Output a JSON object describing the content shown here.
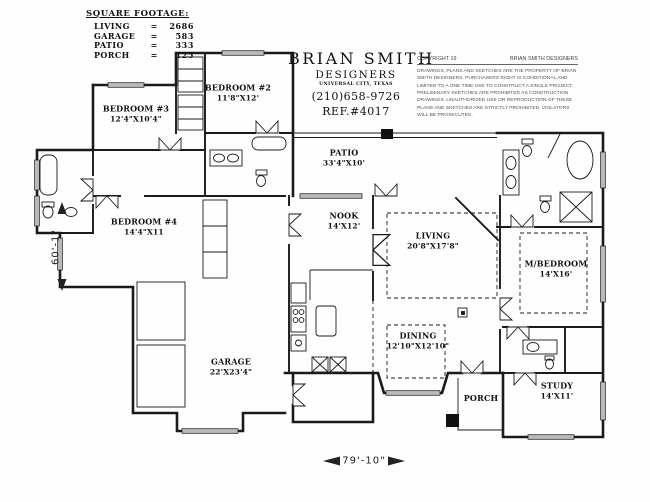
{
  "drawing": {
    "square_footage": {
      "title": "SQUARE FOOTAGE:",
      "equals": "=",
      "rows": [
        {
          "label": "LIVING",
          "value": "2686"
        },
        {
          "label": "GARAGE",
          "value": "583"
        },
        {
          "label": "PATIO",
          "value": "333"
        },
        {
          "label": "PORCH",
          "value": "125"
        }
      ]
    },
    "title_block": {
      "firm": "BRIAN SMITH",
      "firm2": "DESIGNERS",
      "city": "UNIVERSAL CITY, TEXAS",
      "phone": "(210)658-9726",
      "ref": "REF.#4017"
    },
    "copyright": {
      "left": "COPYRIGHT 19",
      "right": "BRIAN SMITH DESIGNERS",
      "body": "DRAWINGS, PLANS AND SKETCHES ARE THE PROPERTY OF BRIAN SMITH DESIGNERS.  PURCHASERS RIGHT IS CONDITIONAL AND LIMITED TO A ONE TIME USE TO CONSTRUCT A SINGLE PROJECT.  PRELIMINARY SKETCHES ARE PROHIBITED AS CONSTRUCTION DRAWINGS.  UNAUTHORIZED USE OR REPRODUCTION OF THESE PLANS AND SKETCHES ARE STRICTLY PROHIBITED.  VIOLATORS WILL BE PROSECUTED."
    },
    "rooms": {
      "bedroom2": {
        "name": "BEDROOM #2",
        "size": "11'8\"X12'"
      },
      "bedroom3": {
        "name": "BEDROOM #3",
        "size": "12'4\"X10'4\""
      },
      "bedroom4": {
        "name": "BEDROOM #4",
        "size": "14'4\"X11"
      },
      "patio": {
        "name": "PATIO",
        "size": "33'4\"X10'"
      },
      "nook": {
        "name": "NOOK",
        "size": "14'X12'"
      },
      "living": {
        "name": "LIVING",
        "size": "20'8\"X17'8\""
      },
      "master_bedroom": {
        "name": "M/BEDROOM",
        "size": "14'X16'"
      },
      "dining": {
        "name": "DINING",
        "size": "12'10\"X12'10\""
      },
      "garage": {
        "name": "GARAGE",
        "size": "22'X23'4\""
      },
      "porch": {
        "name": "PORCH",
        "size": ""
      },
      "study": {
        "name": "STUDY",
        "size": "14'X11'"
      }
    },
    "dimensions": {
      "vertical": "60'-1\"",
      "horizontal": "79'-10\""
    },
    "ink_color": "#1a1a1a",
    "window_color": "#b9b9b9"
  }
}
